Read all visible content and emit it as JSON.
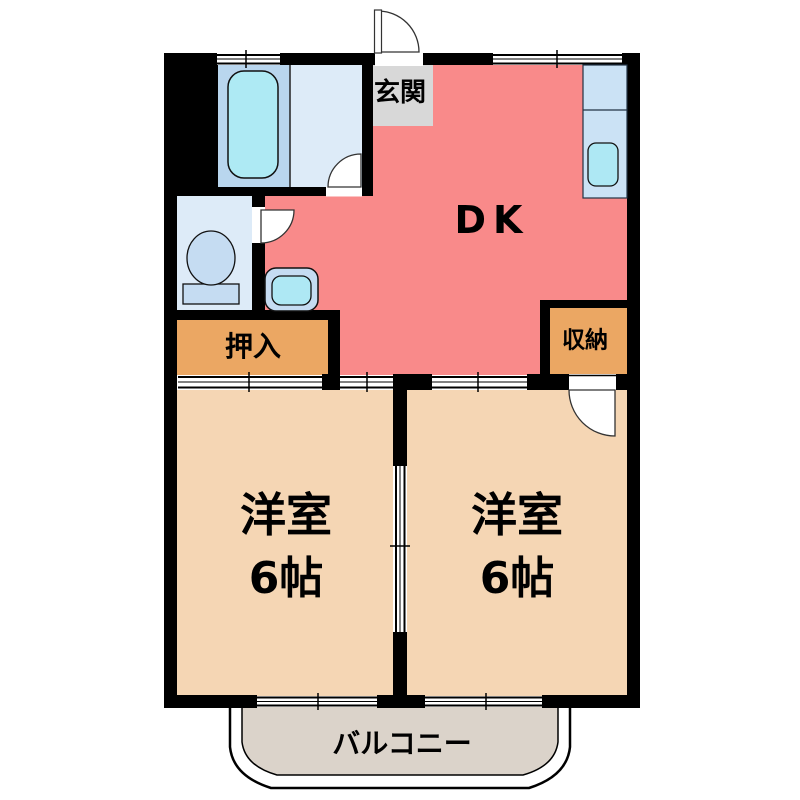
{
  "floor_plan": {
    "entrance": {
      "label": "玄関",
      "color": "#d8d8d8"
    },
    "dining_kitchen": {
      "label": "DK",
      "color": "#f98a8a"
    },
    "closet_oshiire": {
      "label": "押入",
      "color": "#eba763"
    },
    "closet_shunou": {
      "label": "収納",
      "color": "#eba763"
    },
    "room_left": {
      "label": "洋室",
      "size": "6帖",
      "color": "#f5d6b4"
    },
    "room_right": {
      "label": "洋室",
      "size": "6帖",
      "color": "#f5d6b4"
    },
    "balcony": {
      "label": "バルコニー",
      "color": "#dbd3ca"
    }
  },
  "palette": {
    "wall": "#000000",
    "bath_floor": "#b9d6ee",
    "bathtub": "#aeeaf4",
    "washroom_floor": "#ddebf8",
    "toilet_floor": "#ddebf8",
    "fixture_blue": "#c5dcf2",
    "basin_cyan": "#aee8f4",
    "kitchen_counter": "#cbe2f5"
  }
}
